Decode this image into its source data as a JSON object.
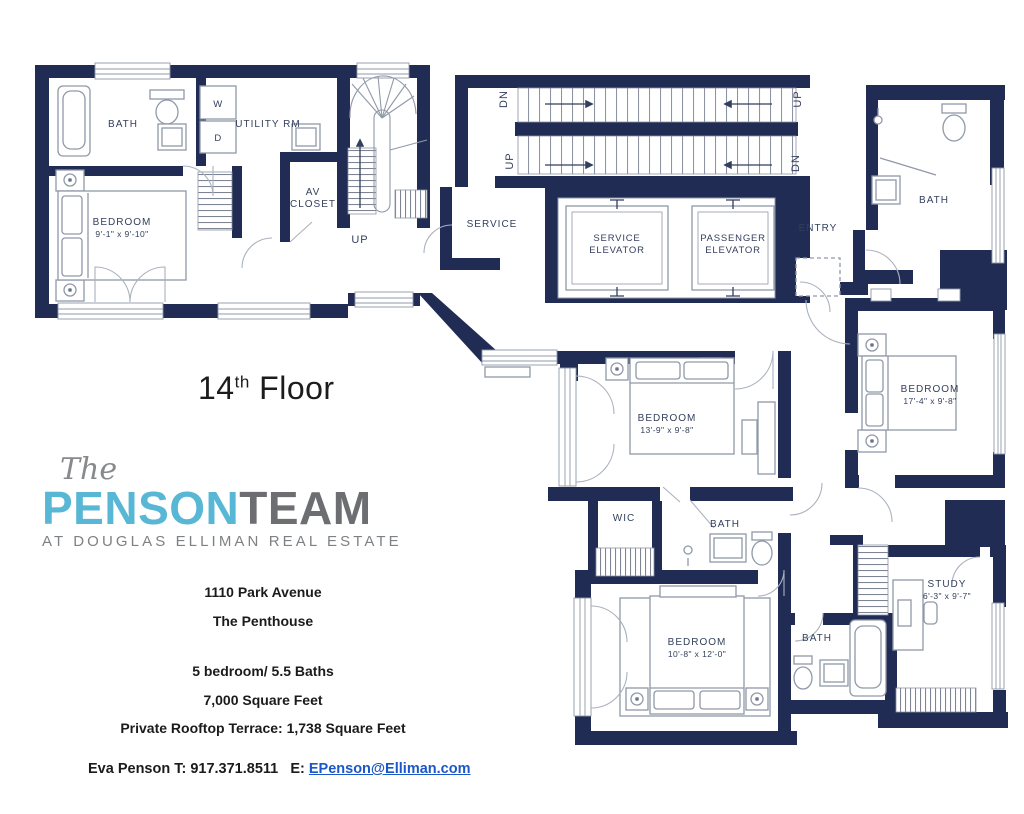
{
  "palette": {
    "wall_navy": "#212C55",
    "penson_blue": "#58B7D4",
    "team_gray": "#6D6E71",
    "link_blue": "#1B57C8"
  },
  "floor_label": {
    "number": "14",
    "suffix": "th",
    "word": " Floor"
  },
  "rooms": {
    "bath_nw": "BATH",
    "utility": "UTILITY RM",
    "washer": "W",
    "dryer": "D",
    "av_closet": {
      "line1": "AV",
      "line2": "CLOSET"
    },
    "bedroom_nw": {
      "label": "BEDROOM",
      "dims": "9'-1\" x 9'-10\""
    },
    "service": "SERVICE",
    "service_elevator": {
      "line1": "SERVICE",
      "line2": "ELEVATOR"
    },
    "passenger_elevator": {
      "line1": "PASSENGER",
      "line2": "ELEVATOR"
    },
    "entry": "ENTRY",
    "bath_ne": "BATH",
    "bedroom_mid": {
      "label": "BEDROOM",
      "dims": "13'-9\" x 9'-8\""
    },
    "bedroom_e": {
      "label": "BEDROOM",
      "dims": "17'-4\" x 9'-8\""
    },
    "wic": "WIC",
    "bath_mid": "BATH",
    "bedroom_s": {
      "label": "BEDROOM",
      "dims": "10'-8\" x 12'-0\""
    },
    "bath_s": "BATH",
    "study": {
      "label": "STUDY",
      "dims": "6'-3\" x 9'-7\""
    }
  },
  "stairs": {
    "dn": "DN",
    "up": "UP"
  },
  "logo": {
    "the": "The",
    "penson": "PENSON",
    "team": "TEAM",
    "tagline": "AT DOUGLAS ELLIMAN REAL ESTATE"
  },
  "listing": {
    "address": "1110 Park Avenue",
    "unit": "The Penthouse",
    "beds_baths": "5 bedroom/ 5.5 Baths",
    "sqft": "7,000 Square Feet",
    "terrace": "Private Rooftop Terrace: 1,738 Square Feet"
  },
  "contact": {
    "name_phone": "Eva Penson T: 917.371.8511",
    "email_label": "E:",
    "email": "EPenson@Elliman.com"
  }
}
